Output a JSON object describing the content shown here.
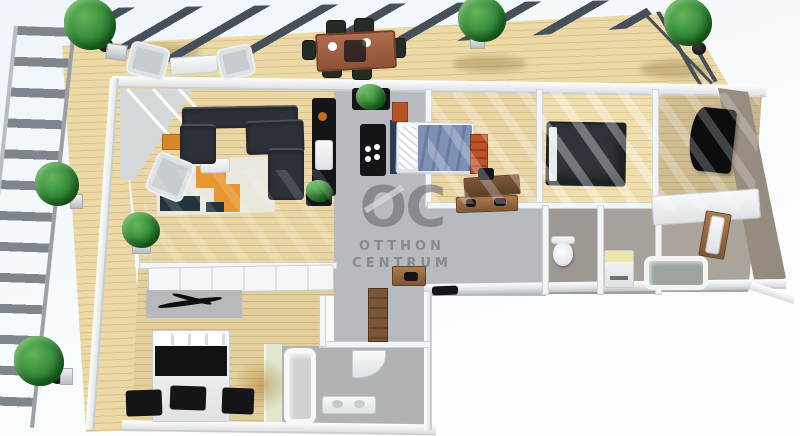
{
  "watermark": {
    "logo": "OC",
    "line1": "OTTHON",
    "line2": "CENTRUM"
  },
  "scene": {
    "type": "3d-floorplan-render",
    "rooms": [
      "terrace",
      "living-room",
      "kitchen",
      "bedroom-1",
      "bedroom-2",
      "bedroom-3",
      "hallway",
      "wc",
      "utility",
      "bathroom-1",
      "bathroom-2"
    ]
  },
  "palette": {
    "deck-wood": "#ecd9a6",
    "deck-line": "#d9c48c",
    "pergola": "#46505b",
    "railing": "#7e868d",
    "wall-white": "#f4f6f7",
    "wall-shade": "#c9ced2",
    "taupe": "#a2998c",
    "wood-floor": "#e9d6a4",
    "wood-floor-light": "#f0dfae",
    "wood-floor-dark": "#e3cf9c",
    "gray-floor": "#b7bbbf",
    "tile": "#aaa49b",
    "sofa": "#2d3138",
    "rug-base": "#eae7de",
    "accent-orange": "#e8962f",
    "bed-blue": "#7e90b3",
    "bed-dark": "#30343a",
    "green-wall": "#dfe7cc",
    "washer-top": "#ece6ab",
    "wood-furn": "#9c6b43",
    "dark-furn": "#131519",
    "watermark": "#60646a"
  }
}
